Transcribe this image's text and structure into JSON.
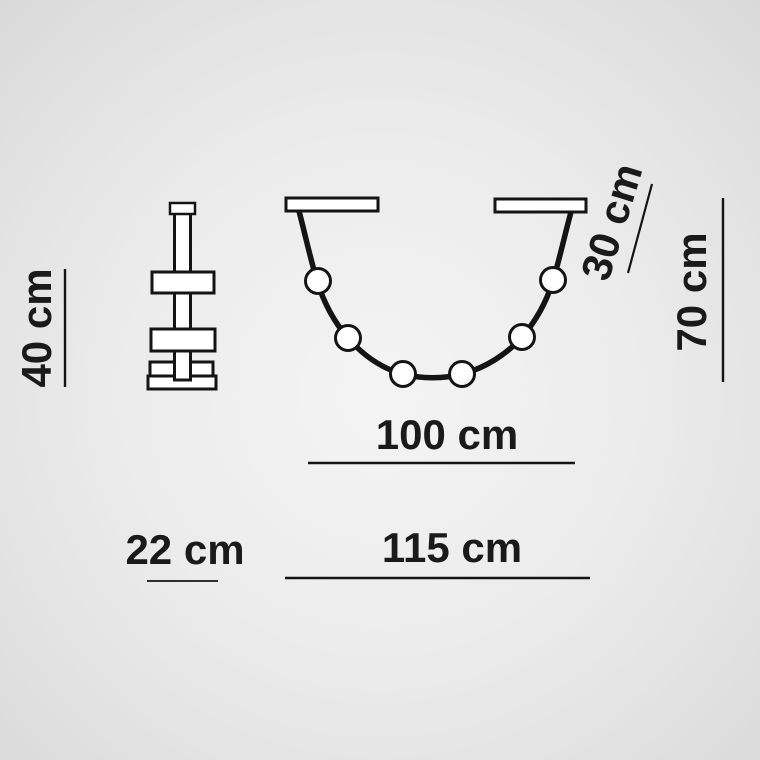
{
  "page": {
    "background_center_color": "#f4f4f4",
    "background_edge_color": "#d8d8d8"
  },
  "diagram": {
    "type": "product-dimension-drawing",
    "subject": "garland pendant light with 6 globe bulbs, front view and side view",
    "line_color": "#141414",
    "shape_fill_color": "#ffffff",
    "text_color": "#1a1a1a",
    "bulb_count": 6,
    "labels": {
      "side_view_height": "40 cm",
      "side_view_width": "22 cm",
      "mount_span": "100 cm",
      "overall_width": "115 cm",
      "cable_drop": "30 cm",
      "overall_height": "70 cm"
    }
  }
}
